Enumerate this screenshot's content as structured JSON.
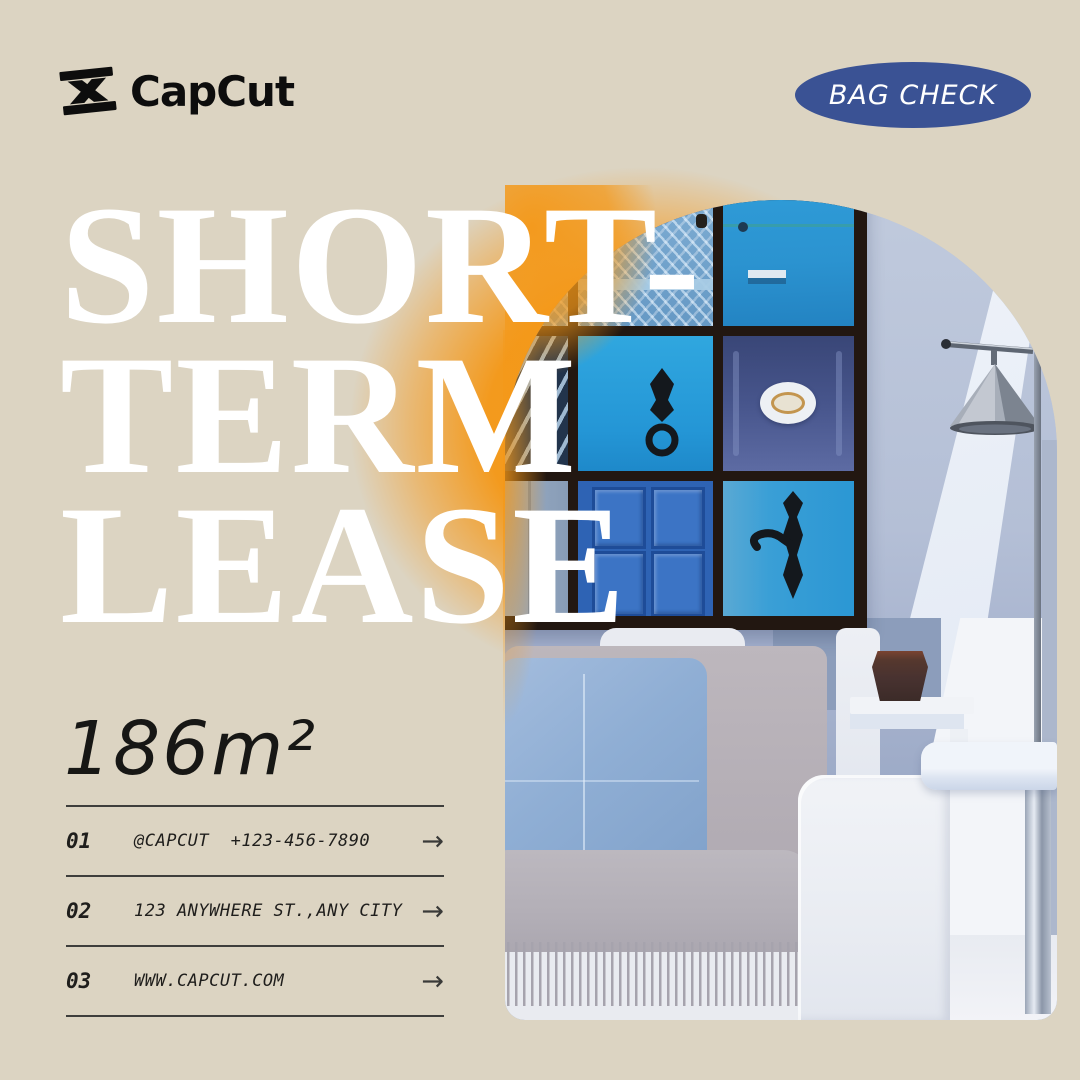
{
  "brand": {
    "name": "CapCut"
  },
  "badge": {
    "label": "BAG CHECK"
  },
  "headline": {
    "lines": [
      "SHORT-",
      "TERM",
      "LEASE"
    ]
  },
  "area_label": "186m²",
  "contacts": {
    "rows": [
      {
        "index": "01",
        "text": "@CAPCUT  +123-456-7890"
      },
      {
        "index": "02",
        "text": "123 ANYWHERE ST.,ANY CITY"
      },
      {
        "index": "03",
        "text": "WWW.CAPCUT.COM"
      }
    ]
  },
  "icons": {
    "arrow": "→"
  },
  "colors": {
    "background_beige": "#DCD4C2",
    "accent_orange": "#F49818",
    "badge_blue": "#3A5294",
    "headline_white": "#FFFFFF",
    "text_dark": "#1F1E1C"
  }
}
